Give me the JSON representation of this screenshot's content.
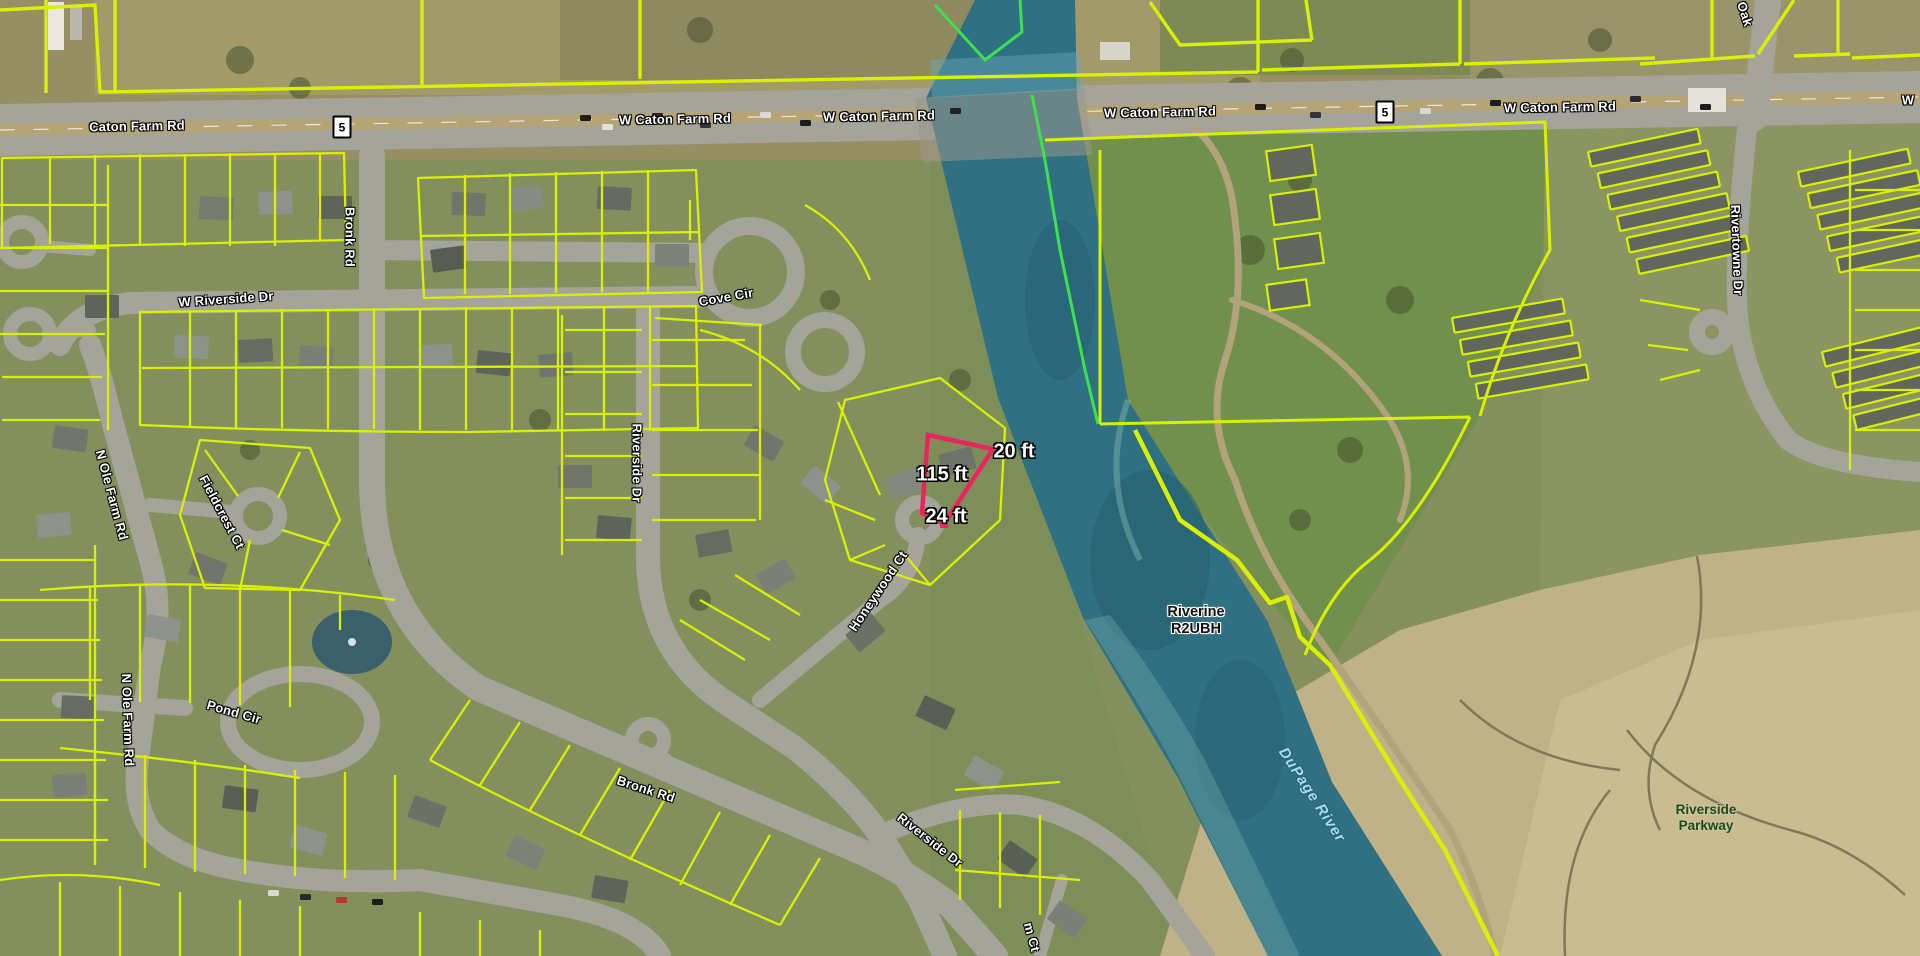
{
  "app": {
    "type": "aerial-parcel-map",
    "colors": {
      "parcel_line": "#d9ef04",
      "boundary_green": "#3fe04e",
      "measurement_pink": "#e8255f",
      "river_water": "#2f7082",
      "road_gray": "#a4a49a",
      "street_label": "#ffffff",
      "river_label_blue": "#a9dcec",
      "marsh_tan": "#c0b288"
    }
  },
  "route_shield": "5",
  "labels": {
    "caton_farm_rd": "Caton Farm Rd",
    "w_caton_farm_rd": "W Caton Farm Rd",
    "w_partial": "W",
    "w_riverside_dr": "W Riverside Dr",
    "bronk_rd": "Bronk Rd",
    "cove_cir": "Cove Cir",
    "riverside_dr": "Riverside Dr",
    "honeywood_ct": "Honeywood Ct",
    "fieldcrest_ct": "Fieldcrest Ct",
    "n_ole_farm_rd": "N Ole Farm Rd",
    "pond_cir": "Pond Cir",
    "rivertowne_dr": "Rivertowne Dr",
    "oak_partial": "Oak",
    "m_ct_partial": "m Ct"
  },
  "wetland_label": {
    "line1": "Riverine",
    "line2": "R2UBH"
  },
  "river_label": "DuPage River",
  "parkway_label": {
    "line1": "Riverside",
    "line2": "Parkway"
  },
  "measurements": {
    "left_edge": "115 ft",
    "top_edge": "20 ft",
    "bottom_edge": "24 ft"
  }
}
